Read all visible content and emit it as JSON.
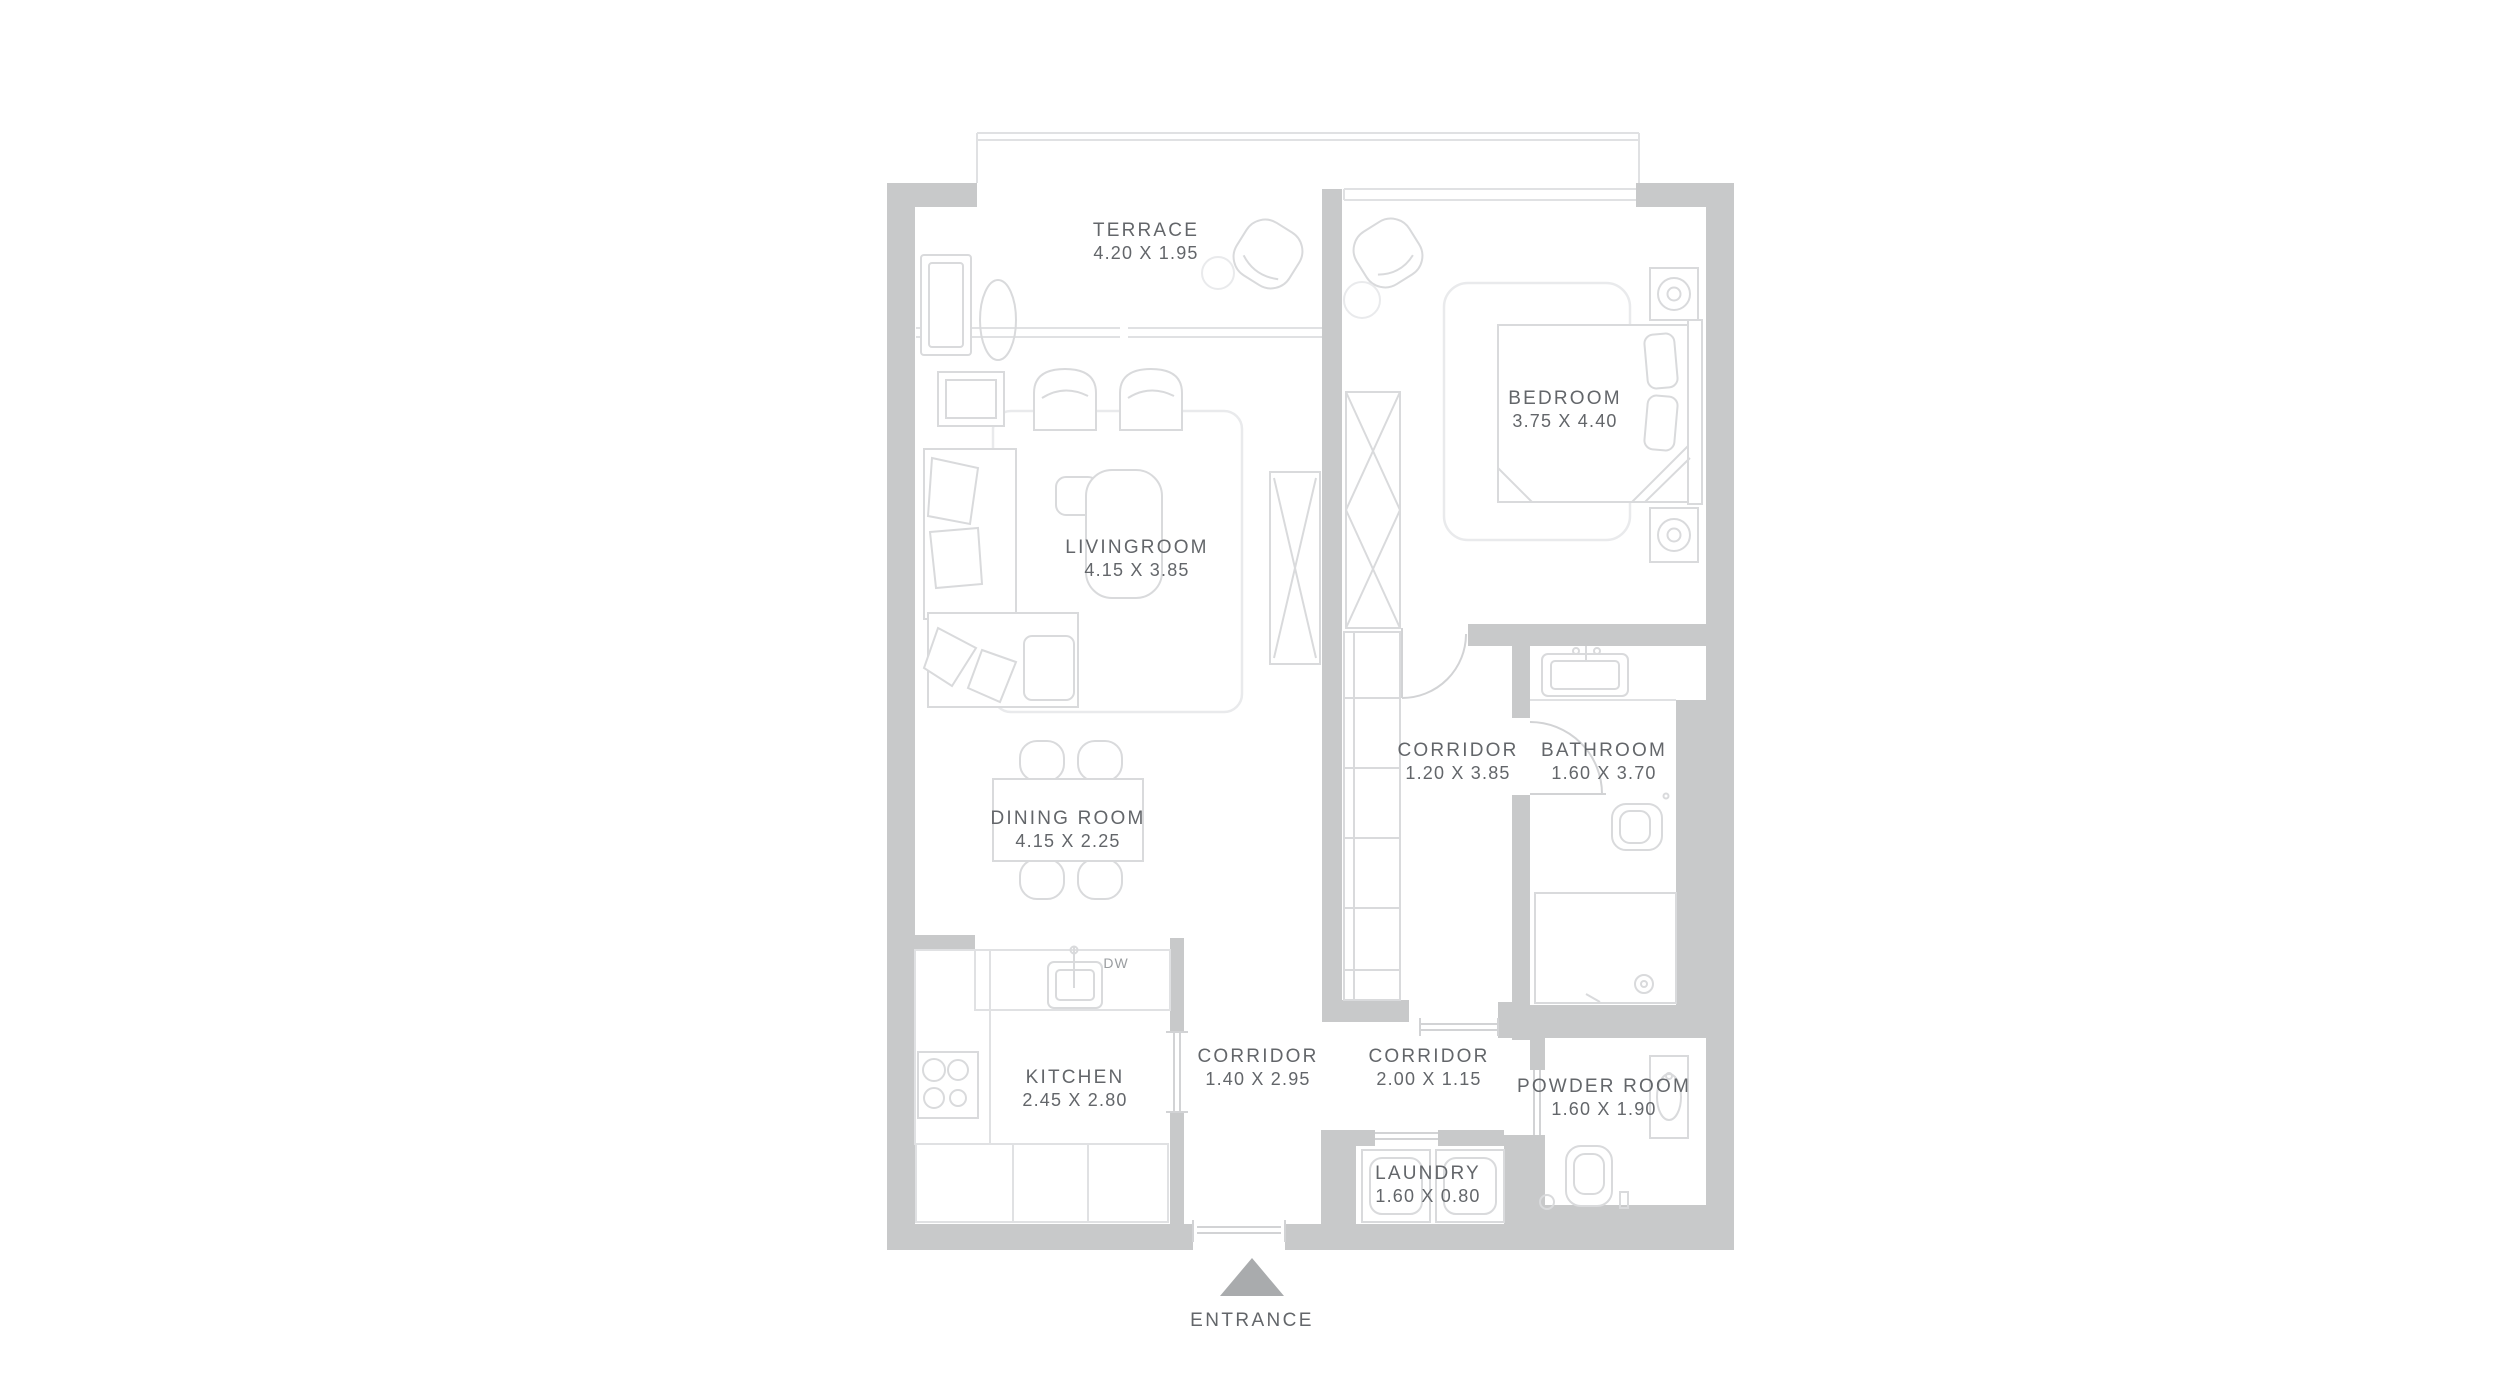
{
  "colors": {
    "wall_color": "#c8c9ca",
    "line_color": "#e0e1e3",
    "furn_color": "#d9dadc",
    "rug_color": "#e9eaec",
    "door_color": "#d2d3d5",
    "text_color": "#63666a",
    "muted_text_color": "#9a9da0",
    "arrow_color": "#a9abad",
    "background": "#ffffff"
  },
  "rooms": [
    {
      "id": "terrace",
      "name": "TERRACE",
      "dims": "4.20 X 1.95"
    },
    {
      "id": "bedroom",
      "name": "BEDROOM",
      "dims": "3.75 X 4.40"
    },
    {
      "id": "livingroom",
      "name": "LIVINGROOM",
      "dims": "4.15 X 3.85"
    },
    {
      "id": "dining-room",
      "name": "DINING ROOM",
      "dims": "4.15 X 2.25"
    },
    {
      "id": "corridor-bedroom",
      "name": "CORRIDOR",
      "dims": "1.20 X 3.85"
    },
    {
      "id": "bathroom",
      "name": "BATHROOM",
      "dims": "1.60 X 3.70"
    },
    {
      "id": "kitchen",
      "name": "KITCHEN",
      "dims": "2.45 X 2.80"
    },
    {
      "id": "corridor-main",
      "name": "CORRIDOR",
      "dims": "1.40 X 2.95"
    },
    {
      "id": "corridor-entry",
      "name": "CORRIDOR",
      "dims": "2.00 X 1.15"
    },
    {
      "id": "powder-room",
      "name": "POWDER ROOM",
      "dims": "1.60 X 1.90"
    },
    {
      "id": "laundry",
      "name": "LAUNDRY",
      "dims": "1.60 X 0.80"
    }
  ],
  "annotations": {
    "entrance": "ENTRANCE",
    "dishwasher": "DW"
  }
}
